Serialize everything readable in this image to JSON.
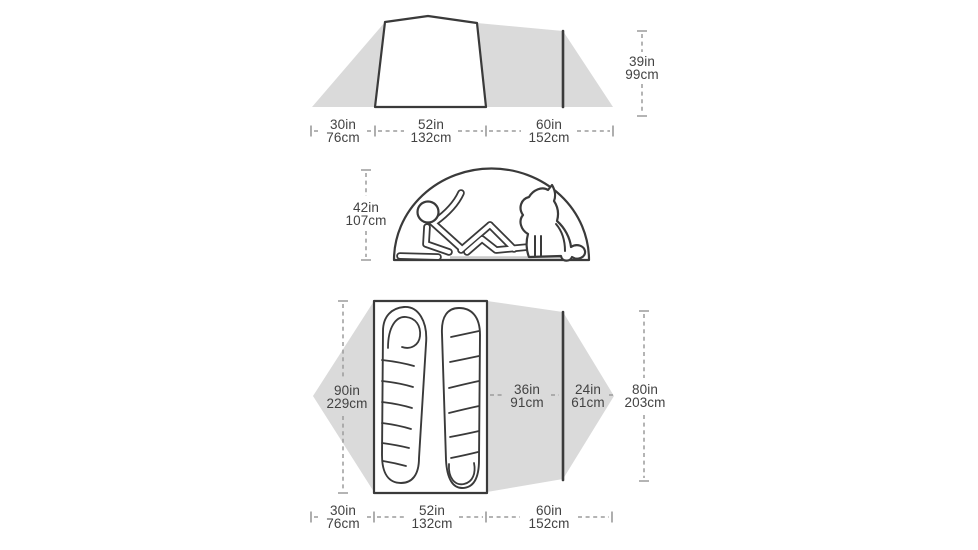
{
  "colors": {
    "background": "#ffffff",
    "silhouette": "#dadada",
    "outline": "#3a3a3a",
    "dim_line": "#9b9b9b",
    "text": "#424242",
    "shadow": "#c9c9c9"
  },
  "side_view": {
    "width_labels": [
      {
        "in": "30in",
        "cm": "76cm"
      },
      {
        "in": "52in",
        "cm": "132cm"
      },
      {
        "in": "60in",
        "cm": "152cm"
      }
    ],
    "height_label": {
      "in": "39in",
      "cm": "99cm"
    }
  },
  "front_view": {
    "height_label": {
      "in": "42in",
      "cm": "107cm"
    }
  },
  "floor_plan": {
    "interior_length_label": {
      "in": "90in",
      "cm": "229cm"
    },
    "vestibule_depth_label": {
      "in": "36in",
      "cm": "91cm"
    },
    "vestibule_extension_label": {
      "in": "24in",
      "cm": "61cm"
    },
    "overall_length_label": {
      "in": "80in",
      "cm": "203cm"
    },
    "width_labels": [
      {
        "in": "30in",
        "cm": "76cm"
      },
      {
        "in": "52in",
        "cm": "132cm"
      },
      {
        "in": "60in",
        "cm": "152cm"
      }
    ]
  }
}
